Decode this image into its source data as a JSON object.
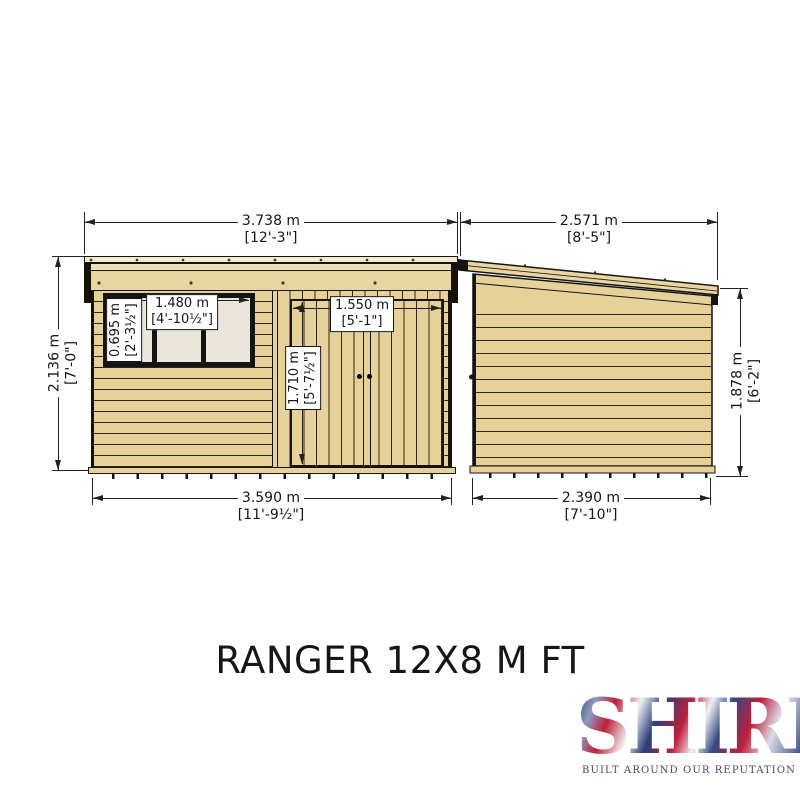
{
  "drawing": {
    "title": "RANGER 12X8 M FT",
    "front_elevation": {
      "overall_width": {
        "metric": "3.738 m",
        "imperial": "[12'-3\"]"
      },
      "overall_height": {
        "metric": "2.136 m",
        "imperial": "[7'-0\"]"
      },
      "base_width": {
        "metric": "3.590 m",
        "imperial": "[11'-9½\"]"
      },
      "window": {
        "width": {
          "metric": "1.480 m",
          "imperial": "[4'-10½\"]"
        },
        "height": {
          "metric": "0.695 m",
          "imperial": "[2'-3½\"]"
        }
      },
      "door": {
        "width": {
          "metric": "1.550 m",
          "imperial": "[5'-1\"]"
        },
        "height": {
          "metric": "1.710 m",
          "imperial": "[5'-7½\"]"
        }
      }
    },
    "side_elevation": {
      "overall_depth": {
        "metric": "2.571 m",
        "imperial": "[8'-5\"]"
      },
      "eaves_height": {
        "metric": "1.878 m",
        "imperial": "[6'-2\"]"
      },
      "base_depth": {
        "metric": "2.390 m",
        "imperial": "[7'-10\"]"
      }
    }
  },
  "branding": {
    "logo_text": "SHIRE",
    "tagline": "BUILT AROUND OUR REPUTATION"
  },
  "colors": {
    "wood": "#e6d298",
    "wood_light": "#e8d5a0",
    "outline": "#141414",
    "window_pane": "#eae6da",
    "brand_red": "#c01f3a",
    "brand_blue": "#2a3e79"
  }
}
